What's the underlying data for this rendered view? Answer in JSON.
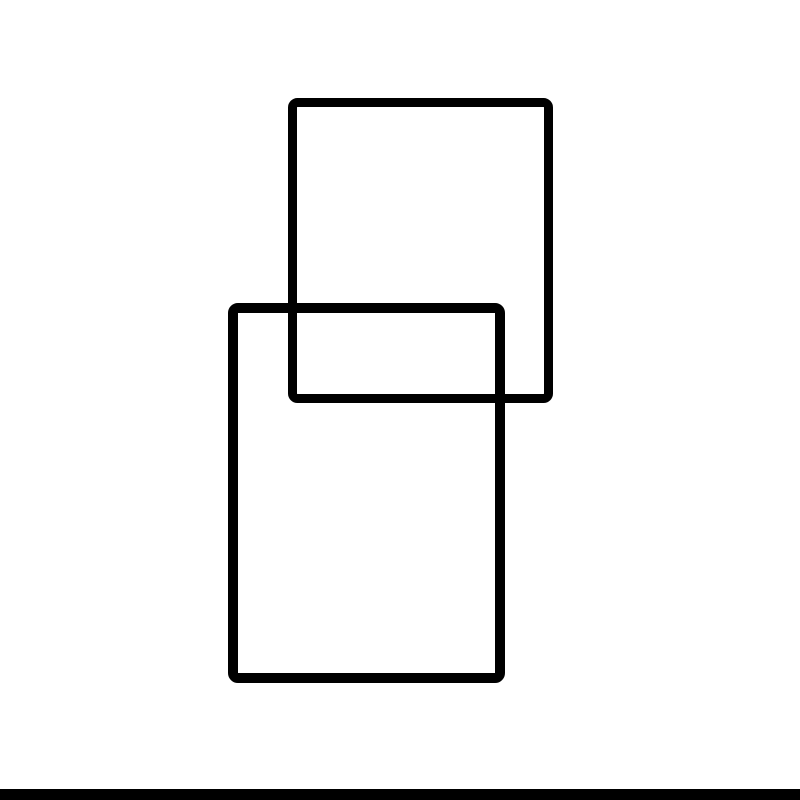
{
  "canvas": {
    "width": 800,
    "height": 800,
    "background": "#ffffff"
  },
  "figure": {
    "description": "two overlapping outlined rectangles",
    "stroke_color": "#000000",
    "fill": "none"
  },
  "shapes": [
    {
      "name": "upper-rectangle",
      "type": "rect",
      "x": 288,
      "y": 98,
      "width": 265,
      "height": 305,
      "stroke": "#000000",
      "stroke_width": 9,
      "fill": "none",
      "corner_radius": 5
    },
    {
      "name": "lower-rectangle",
      "type": "rect",
      "x": 228,
      "y": 303,
      "width": 277,
      "height": 380,
      "stroke": "#000000",
      "stroke_width": 10,
      "fill": "none",
      "corner_radius": 5
    }
  ],
  "bottom_bar": {
    "x": 0,
    "y": 789,
    "width": 800,
    "height": 11,
    "color": "#000000"
  }
}
